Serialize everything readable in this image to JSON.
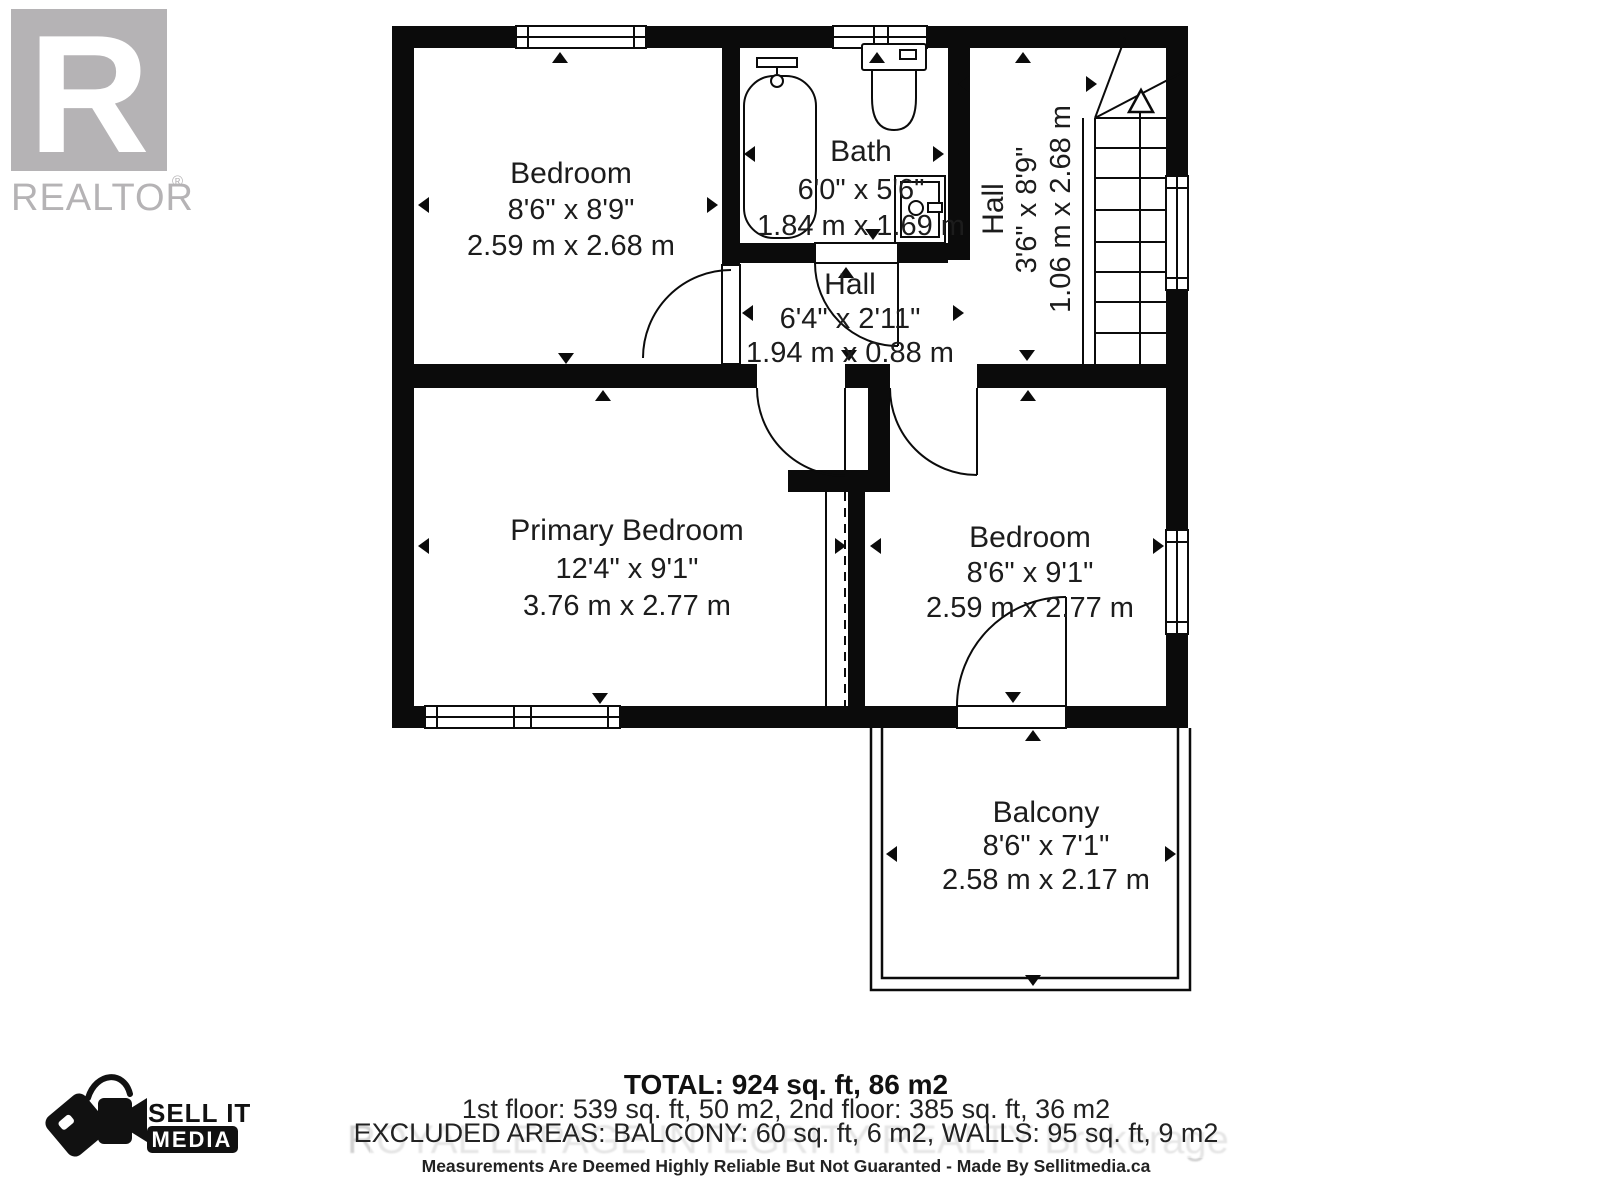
{
  "branding": {
    "realtor": {
      "letter": "R",
      "label": "REALTOR",
      "registered": "®"
    },
    "sellit": {
      "line1": "SELL IT",
      "line2": "MEDIA"
    },
    "watermark": "ROYAL LEPAGE INTEGRITY REALTY  Brokerage"
  },
  "rooms": [
    {
      "id": "bedroom-top-left",
      "name": "Bedroom",
      "imperial": "8'6\" x 8'9\"",
      "metric": "2.59 m x 2.68 m"
    },
    {
      "id": "bath",
      "name": "Bath",
      "imperial": "6'0\" x 5'6\"",
      "metric": "1.84 m x 1.69 m"
    },
    {
      "id": "hall-small",
      "name": "Hall",
      "imperial": "6'4\" x 2'11\"",
      "metric": "1.94 m x 0.88 m"
    },
    {
      "id": "hall-stairs",
      "name": "Hall",
      "imperial": "3'6\" x 8'9\"",
      "metric": "1.06 m x 2.68 m"
    },
    {
      "id": "primary-bedroom",
      "name": "Primary Bedroom",
      "imperial": "12'4\" x 9'1\"",
      "metric": "3.76 m x 2.77 m"
    },
    {
      "id": "bedroom-right",
      "name": "Bedroom",
      "imperial": "8'6\" x 9'1\"",
      "metric": "2.59 m x 2.77 m"
    },
    {
      "id": "balcony",
      "name": "Balcony",
      "imperial": "8'6\" x 7'1\"",
      "metric": "2.58 m x 2.17 m"
    }
  ],
  "summary": {
    "total": "TOTAL: 924 sq. ft, 86 m2",
    "floors": "1st floor: 539 sq. ft, 50 m2, 2nd floor: 385 sq. ft, 36 m2",
    "excluded": "EXCLUDED AREAS: BALCONY: 60 sq. ft, 6 m2, WALLS: 95 sq. ft, 9 m2",
    "disclaimer": "Measurements Are Deemed Highly Reliable But Not Guaranted - Made By Sellitmedia.ca"
  },
  "colors": {
    "wall": "#0b0b0b",
    "text": "#1c1c1c",
    "logo_gray": "#b5b3b5",
    "watermark_gray": "#c9c9c9"
  }
}
